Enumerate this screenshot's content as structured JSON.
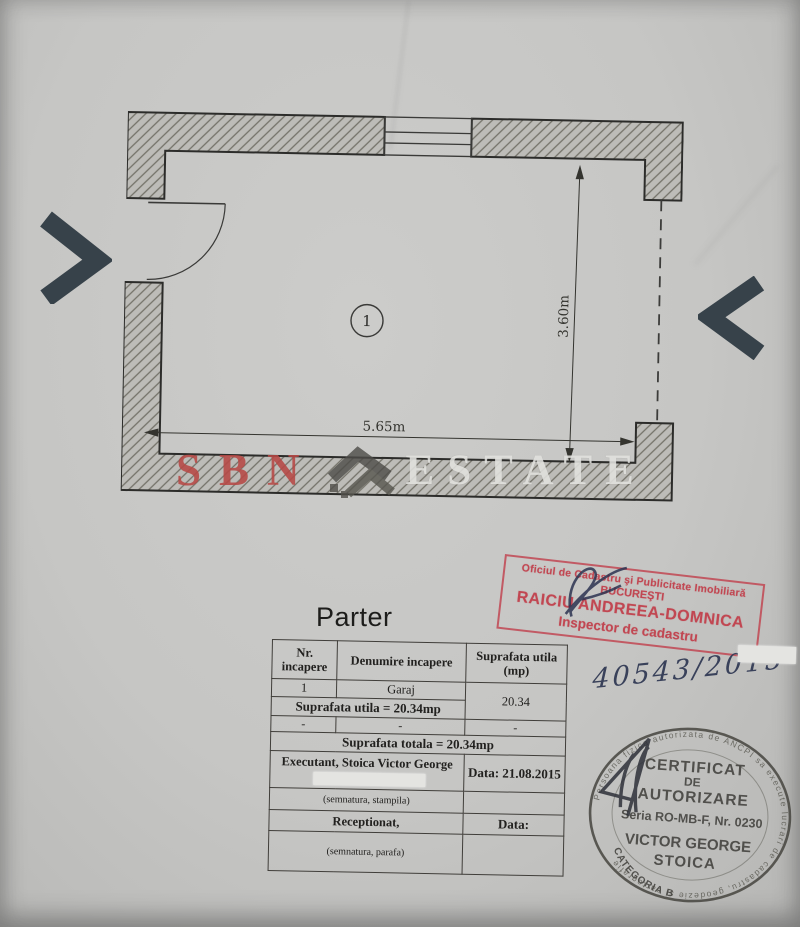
{
  "title": "Parter",
  "plan": {
    "room_number": "1",
    "width_label": "5.65m",
    "height_label": "3.60m"
  },
  "watermark": {
    "sbn": "SBN",
    "estate": "ESTATE"
  },
  "handwritten_number": "40543/2015",
  "table": {
    "headers": {
      "col1": "Nr. incapere",
      "col2": "Denumire incapere",
      "col3": "Suprafata utila (mp)"
    },
    "room_row": {
      "nr": "1",
      "name": "Garaj",
      "area": "20.34"
    },
    "sum_utila": "Suprafata utila =  20.34mp",
    "dash_row": {
      "c1": "-",
      "c2": "-",
      "c3": "-"
    },
    "sum_totala": "Suprafata totala =  20.34mp",
    "executant_line1": "Executant, Stoica Victor George",
    "executant_line2": "Telef.",
    "executant_data": "Data: 21.08.2015",
    "note_stampila": "(semnatura, stampila)",
    "receptionat": "Receptionat,",
    "receptionat_data": "Data:",
    "note_parafa": "(semnatura, parafa)"
  },
  "red_stamp": {
    "line1": "Oficiul de Cadastru şi Publicitate Imobiliară",
    "line2": "BUCUREŞTI",
    "line3": "RAICIU ANDREEA-DOMNICA",
    "line4": "Inspector de cadastru"
  },
  "round_stamp": {
    "ring_text": "Persoana fizica autorizata de ANCPI sa execute lucrari de cadastru, geodezie si cartografie",
    "line1": "CERTIFICAT",
    "line2": "DE",
    "line3": "AUTORIZARE",
    "line4": "Seria RO-MB-F, Nr. 0230",
    "line5": "VICTOR GEORGE",
    "line6": "STOICA",
    "bottom_arc": "CATEGORIA B"
  },
  "colors": {
    "stamp_red": "#c14752",
    "watermark_red": "#b64844",
    "arrow_slate": "#37424a",
    "ink_blue": "#2b3350"
  }
}
